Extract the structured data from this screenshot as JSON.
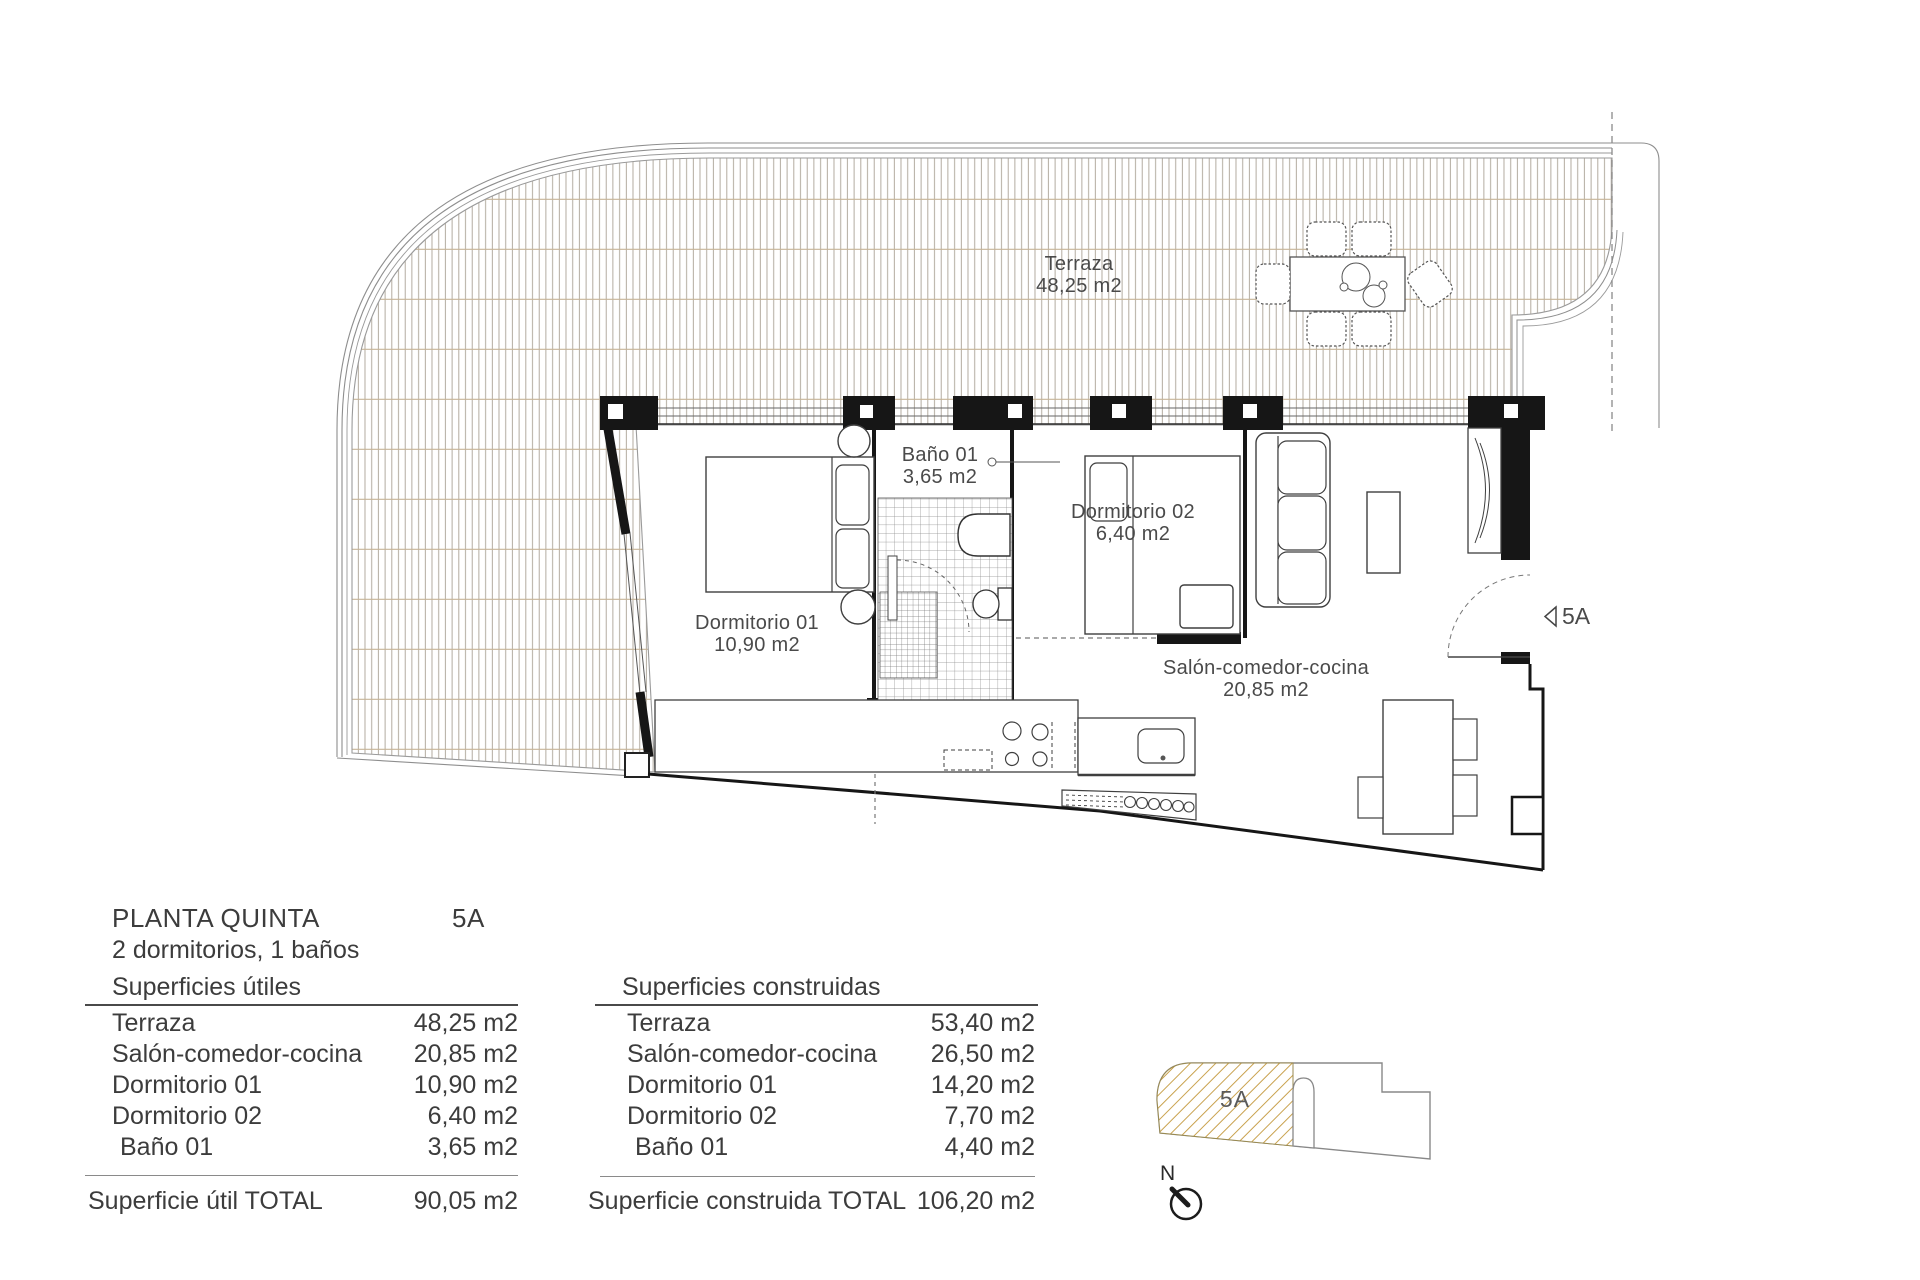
{
  "plan": {
    "terrace": {
      "name": "Terraza",
      "area": "48,25 m2"
    },
    "bathroom": {
      "name": "Baño 01",
      "area": "3,65 m2"
    },
    "bedroom1": {
      "name": "Dormitorio 01",
      "area": "10,90 m2"
    },
    "bedroom2": {
      "name": "Dormitorio 02",
      "area": "6,40 m2"
    },
    "living": {
      "name": "Salón-comedor-cocina",
      "area": "20,85 m2"
    },
    "entrance_label": "5A"
  },
  "summary": {
    "title": "PLANTA QUINTA",
    "unit": "5A",
    "subtitle": "2 dormitorios, 1 baños",
    "useful": {
      "header": "Superficies útiles",
      "rows": [
        {
          "label": "Terraza",
          "value": "48,25 m2"
        },
        {
          "label": "Salón-comedor-cocina",
          "value": "20,85 m2"
        },
        {
          "label": "Dormitorio 01",
          "value": "10,90 m2"
        },
        {
          "label": "Dormitorio 02",
          "value": "6,40 m2"
        },
        {
          "label": "Baño 01",
          "value": "3,65 m2"
        }
      ],
      "total_label": "Superficie útil TOTAL",
      "total_value": "90,05 m2"
    },
    "built": {
      "header": "Superficies construidas",
      "rows": [
        {
          "label": "Terraza",
          "value": "53,40 m2"
        },
        {
          "label": "Salón-comedor-cocina",
          "value": "26,50 m2"
        },
        {
          "label": "Dormitorio 01",
          "value": "14,20 m2"
        },
        {
          "label": "Dormitorio 02",
          "value": "7,70 m2"
        },
        {
          "label": "Baño 01",
          "value": "4,40 m2"
        }
      ],
      "total_label": "Superficie construida TOTAL",
      "total_value": "106,20 m2"
    }
  },
  "keyplan": {
    "unit_label": "5A",
    "north_label": "N"
  },
  "colors": {
    "wall": "#161616",
    "text": "#3c3c3c",
    "deck_line": "#aaa295",
    "deck_grid": "#c6b396",
    "hatch": "#c9a24e",
    "thin_line": "#3f3f3f"
  }
}
